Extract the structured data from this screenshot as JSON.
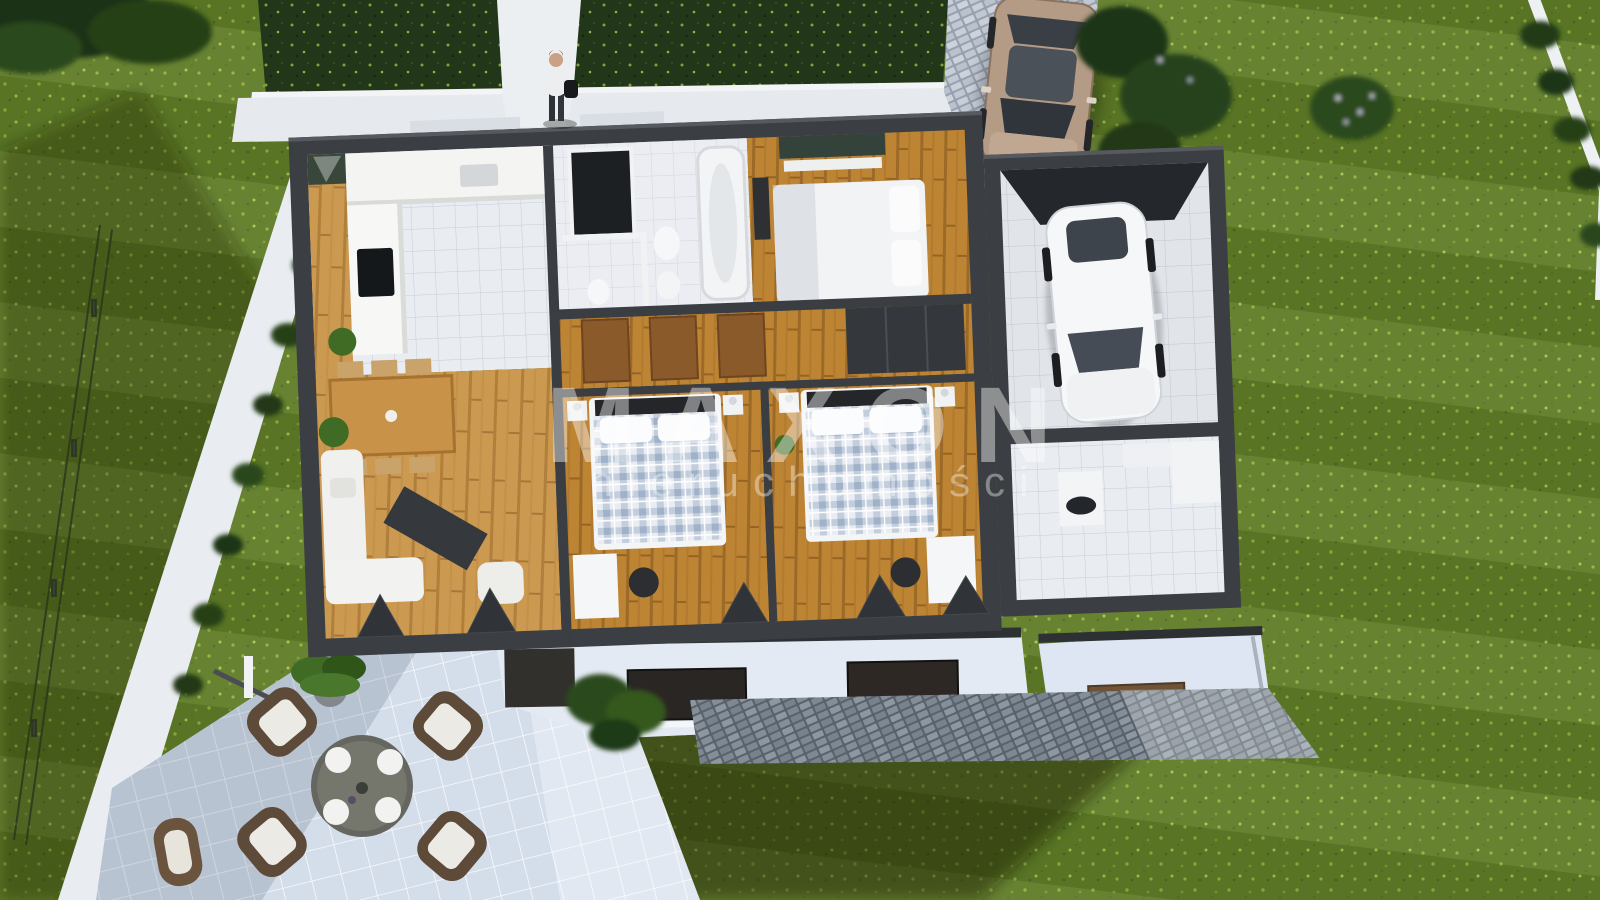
{
  "watermark": {
    "title": "MAXON",
    "subtitle": "nieruchomości"
  },
  "palette": {
    "lawn_green": "#5d7b26",
    "hedge_green": "#223619",
    "wall_dark_gray": "#3b3e42",
    "interior_white": "#f4f5f2",
    "wood_floor_light": "#cb9a50",
    "wood_floor_warm": "#bd8434",
    "indoor_tile": "#e9ecf1",
    "terrace_tile": "#d4ddea",
    "cobble_light": "#c8cfd9",
    "cobble_dark": "#59626b",
    "garage_car_white": "#f6f7f8",
    "driveway_car_beige": "#b49b86",
    "bed_plaid_blue": "#9fb2c9",
    "door_wood_brown": "#8a5a2b",
    "watermark_white": "#ffffff"
  }
}
